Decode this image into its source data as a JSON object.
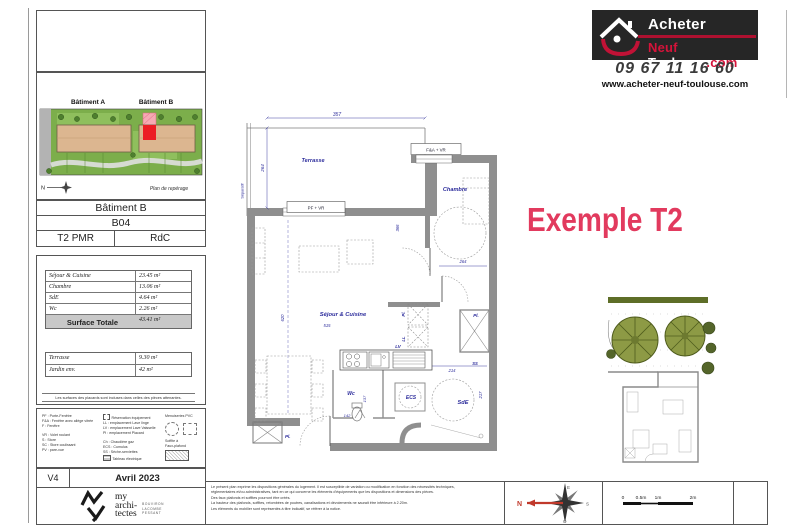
{
  "brand": {
    "name_top": "Acheter",
    "name_red": "Neuf",
    "name_white": "Toulouse",
    "name_tld": ".com",
    "phone": "09 67 11 16 60",
    "website": "www.acheter-neuf-toulouse.com"
  },
  "example_title": "Exemple T2",
  "siteplan": {
    "batiment_a": "Bâtiment A",
    "batiment_b": "Bâtiment B",
    "north": "N",
    "caption": "Plan de repérage"
  },
  "unit": {
    "building": "Bâtiment B",
    "lot": "B04",
    "type": "T2 PMR",
    "level": "RdC"
  },
  "surfaces": {
    "rows": [
      {
        "label": "Séjour & Cuisine",
        "value": "23.45 m²"
      },
      {
        "label": "Chambre",
        "value": "13.06 m²"
      },
      {
        "label": "SdE",
        "value": "4.64 m²"
      },
      {
        "label": "Wc",
        "value": "2.26 m²"
      }
    ],
    "total_label": "Surface Totale",
    "total_value": "43.41 m²",
    "ext_rows": [
      {
        "label": "Terrasse",
        "value": "9.30 m²"
      },
      {
        "label": "Jardin  env.",
        "value": "42 m²"
      }
    ],
    "note": "Les surfaces des placards sont incluses dans celles des pièces attenantes."
  },
  "legend": {
    "col1": [
      "PF : Porte-Fenêtre",
      "F&A : Fenêtre avec allège vitrée",
      "F : Fenêtre",
      "VR : Volet roulant",
      "S : Store",
      "SC : Store coulissant",
      "PV : pare-vue"
    ],
    "col2": [
      "Réservation équipement",
      "LL : emplacement Lave linge",
      "LV : emplacement Lave Vaisselle",
      "Pl : emplacement Placard",
      "Ch : Chaudière gaz",
      "ECS : Cumulus",
      "SS : Sèche-serviettes",
      "Tableau électrique"
    ],
    "col3_title": "Menuiseries PVC",
    "soffite1": "Soffite à",
    "soffite2": "Faux-plafond"
  },
  "version": {
    "code": "V4",
    "date": "Avril 2023"
  },
  "architect": {
    "word1": "my",
    "word2": "archi-",
    "word3": "tectes",
    "names": [
      "BOUVIRON",
      "LACOMBE",
      "PESSANT"
    ]
  },
  "plan": {
    "terrasse": "Terrasse",
    "chambre": "Chambre",
    "sejour": "Séjour & Cuisine",
    "wc": "Wc",
    "sde": "SdE",
    "ecs": "ECS",
    "lv": "LV",
    "ll": "LL",
    "pl": "Pl.",
    "pl2": "Pl.",
    "pl3": "Pl.",
    "ss": "SS",
    "separatif": "Séparatif",
    "win_pf": "PF + VR",
    "win_fa": "F&A + VR",
    "d357": "357",
    "d264_terrasse": "264",
    "d264_chambre": "264",
    "d366": "366",
    "d620": "620",
    "d515": "515",
    "d214": "214",
    "d217": "217",
    "d142": "142",
    "d137": "137"
  },
  "legal": {
    "lines": [
      "Le présent plan exprime les dispositions générales du logement. Il est susceptible de variation ou modification en fonction des nécessités techniques,",
      "réglementaires et/ou administratives, tant en ce qui concerne les éléments d'équipements que les dispositions et dimensions des pièces.",
      "Des faux plafonds et soffites pourront être créés.",
      "La hauteur des plafonds, soffites, retombées de poutres, canalisations et dévoiements ne saurait être inférieure à 2.20m.",
      "Les éléments du mobilier sont représentés à titre indicatif, se référer à la notice."
    ]
  },
  "compass": {
    "n": "N",
    "e": "E",
    "s": "S",
    "o": "O"
  },
  "scale": {
    "t0": "0",
    "t05": "0.5m",
    "t1": "1m",
    "t2": "2m"
  }
}
